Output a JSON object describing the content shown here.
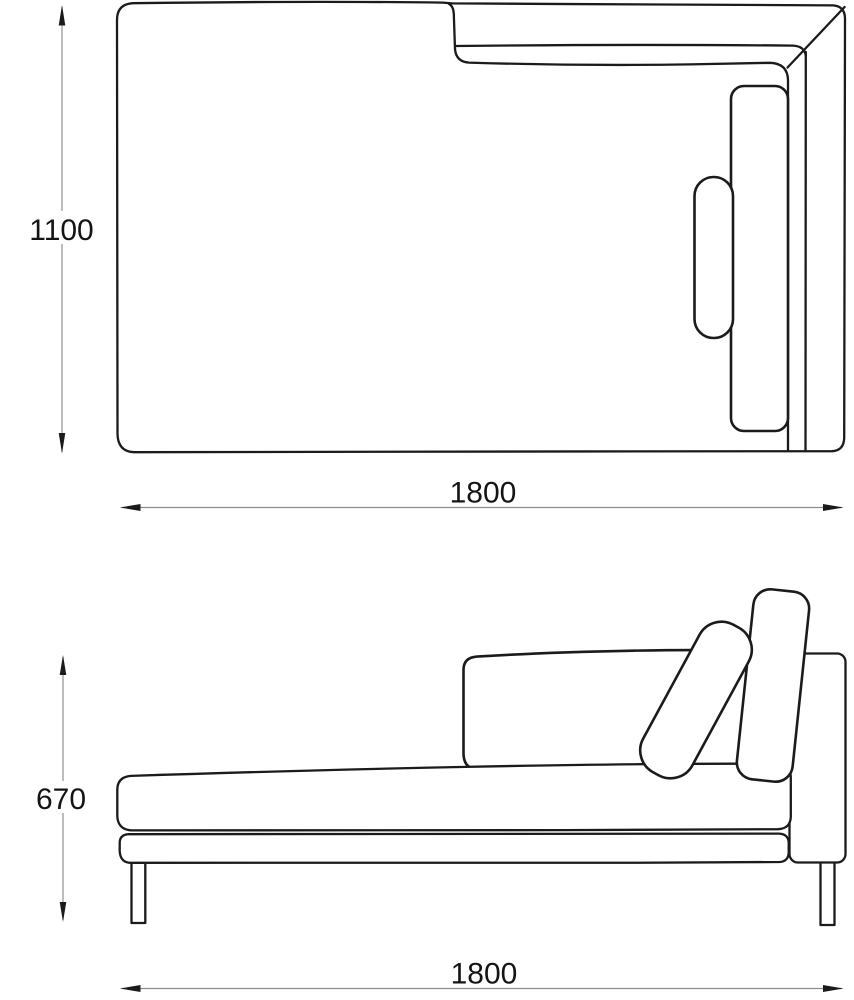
{
  "drawing": {
    "views": [
      {
        "id": "top-view",
        "height_dimension": "1100",
        "width_dimension": "1800"
      },
      {
        "id": "side-view",
        "height_dimension": "670",
        "width_dimension": "1800"
      }
    ]
  },
  "dimensions": {
    "top_view_depth": "1100",
    "top_view_width": "1800",
    "side_view_height": "670",
    "side_view_width": "1800"
  },
  "colors": {
    "background": "#ffffff",
    "outline": "#1b1b1b",
    "dimension_line": "#8c8c8c",
    "dimension_text": "#141414",
    "arrowhead": "#1b1b1b"
  }
}
